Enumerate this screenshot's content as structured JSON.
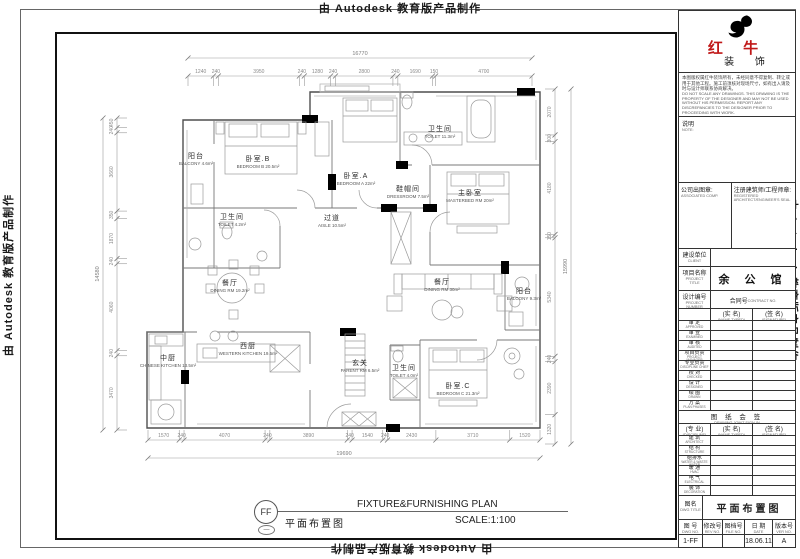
{
  "banner": {
    "text": "由 Autodesk 教育版产品制作"
  },
  "caption": {
    "symbol": "FF",
    "symbol_sub": "—",
    "title_cn": "平面布置图",
    "title_en": "FIXTURE&FURNISHING PLAN",
    "scale": "SCALE:1:100"
  },
  "rooms": [
    {
      "cn": "阳台",
      "en": "BALCONY 4.6m²"
    },
    {
      "cn": "卧室.B",
      "en": "BEDROOM B 20.5m²"
    },
    {
      "cn": "卧室.A",
      "en": "BEDROOM A 22m²"
    },
    {
      "cn": "卫生间",
      "en": "TOILET 11.3m²"
    },
    {
      "cn": "鞋帽间",
      "en": "DRESSROOM 7.5m²"
    },
    {
      "cn": "主卧室",
      "en": "MASTERBED RM 20m²"
    },
    {
      "cn": "卫生间",
      "en": "TOILET 4.2m²"
    },
    {
      "cn": "过道",
      "en": "AISLE 10.5m²"
    },
    {
      "cn": "餐厅",
      "en": "DINING RM 19.2m²"
    },
    {
      "cn": "餐厅",
      "en": "DINING RM 30m²"
    },
    {
      "cn": "阳台",
      "en": "BALCONY 9.3m²"
    },
    {
      "cn": "中厨",
      "en": "CHINESE KITCHEN 13.5m²"
    },
    {
      "cn": "西厨",
      "en": "WESTERN KITCHEN 19.5m²"
    },
    {
      "cn": "玄关",
      "en": "PARENT RM 6.5m²"
    },
    {
      "cn": "卫生间",
      "en": "TOILET 4.0m²"
    },
    {
      "cn": "卧室.C",
      "en": "BEDROOM C 21.3m²"
    }
  ],
  "dims": {
    "top": {
      "total": "16770",
      "segments": [
        "1240",
        "240",
        "3950",
        "240",
        "1280",
        "240",
        "2800",
        "240",
        "1690",
        "150",
        "4700"
      ]
    },
    "bottom": {
      "total": "19690",
      "segments": [
        "1570",
        "240",
        "4070",
        "240",
        "3890",
        "240",
        "1540",
        "240",
        "2430",
        "3710",
        "1520"
      ]
    },
    "left": {
      "total": "14580",
      "segments": [
        "450",
        "240",
        "3660",
        "350",
        "1870",
        "240",
        "4060",
        "240",
        "3470"
      ]
    },
    "right": {
      "total": "15990",
      "segments": [
        "2070",
        "300",
        "4180",
        "150",
        "5340",
        "240",
        "2390",
        "1320"
      ]
    }
  },
  "titleblock": {
    "logo": {
      "cn1": "红 牛",
      "cn2": "装 饰"
    },
    "disclaimer_cn": "本图版权属红牛装饰所有，未经同意不得复制、转让或用于其他工程。施工前须核对现场尺寸，如有出入请及时与设计师联系协商解决。",
    "disclaimer_en": "DO NOT SCALE ANY DRAWINGS. THIS DRAWING IS THE PROPERTY OF THE DESIGNER AND MAY NOT BE USED WITHOUT HIS PERMISSION. REPORT ANY DISCREPANCIES TO THE DESIGNER PRIOR TO PROCEEDING WITH WORK.",
    "note": {
      "cn": "说明",
      "en": "NOTE:"
    },
    "company_seal": {
      "cn": "公司出图章:",
      "en": "ASSOCIATED COMP."
    },
    "engineer_seal": {
      "cn": "注册建筑师/工程师章:",
      "en": "REGISTERED ARCHITECT/ENGINEER'S SEAL"
    },
    "client": {
      "cn": "建设单位",
      "en": "CLIENT"
    },
    "project": {
      "cn": "项目名称",
      "en": "PROJECT TITLE",
      "value": "余 公 馆"
    },
    "design_no": {
      "cn": "设计编号",
      "en": "PROJECT NUMBER"
    },
    "contract_no": {
      "cn": "合同号",
      "en": "CONTRACT NO."
    },
    "col_name": {
      "cn": "(实 名)",
      "en": "(NAME TYPED)"
    },
    "col_sign": {
      "cn": "(签 名)",
      "en": "(SIGNATURE)"
    },
    "col_disc": {
      "cn": "(专 业)",
      "en": "(DISCIPLINE)"
    },
    "sign_rows": [
      {
        "cn": "审 定",
        "en": "APPROVED"
      },
      {
        "cn": "审 查",
        "en": "EXAMINED"
      },
      {
        "cn": "审 核",
        "en": "AUDITED"
      },
      {
        "cn": "项目负责",
        "en": "PROJECT MANAGER"
      },
      {
        "cn": "专业负责",
        "en": "DISCIPLINE CHIEF"
      },
      {
        "cn": "校 对",
        "en": "CHECKED"
      },
      {
        "cn": "设 计",
        "en": "DESIGNED"
      },
      {
        "cn": "绘 图",
        "en": "DRAWN"
      },
      {
        "cn": "方 案",
        "en": "PLAN PHASES"
      }
    ],
    "joint_sign": {
      "cn": "图 纸 会 签",
      "en": "DRAWING JOINT SIGN-IN"
    },
    "disc_rows": [
      {
        "cn": "建 筑",
        "en": "ARCHITECT"
      },
      {
        "cn": "结 构",
        "en": "STRUCTURE"
      },
      {
        "cn": "给排水",
        "en": "WATER & WASTE WATER"
      },
      {
        "cn": "暖 通",
        "en": "HVAC"
      },
      {
        "cn": "电 气",
        "en": "ELECTRICAL"
      },
      {
        "cn": "装 饰",
        "en": "DECORATION"
      }
    ],
    "drawing_title": {
      "cn": "图名",
      "en": "DWG TITLE",
      "value": "平面布置图"
    },
    "bottom": {
      "headers": [
        {
          "cn": "图 号",
          "en": "DWG NO."
        },
        {
          "cn": "修改号",
          "en": "REV NO."
        },
        {
          "cn": "图档号",
          "en": "FILE NO."
        },
        {
          "cn": "日 期",
          "en": "DATE"
        },
        {
          "cn": "版本号",
          "en": "VER NO."
        }
      ],
      "values": [
        "1-FF",
        "",
        "",
        "18.06.11",
        "A"
      ]
    }
  }
}
